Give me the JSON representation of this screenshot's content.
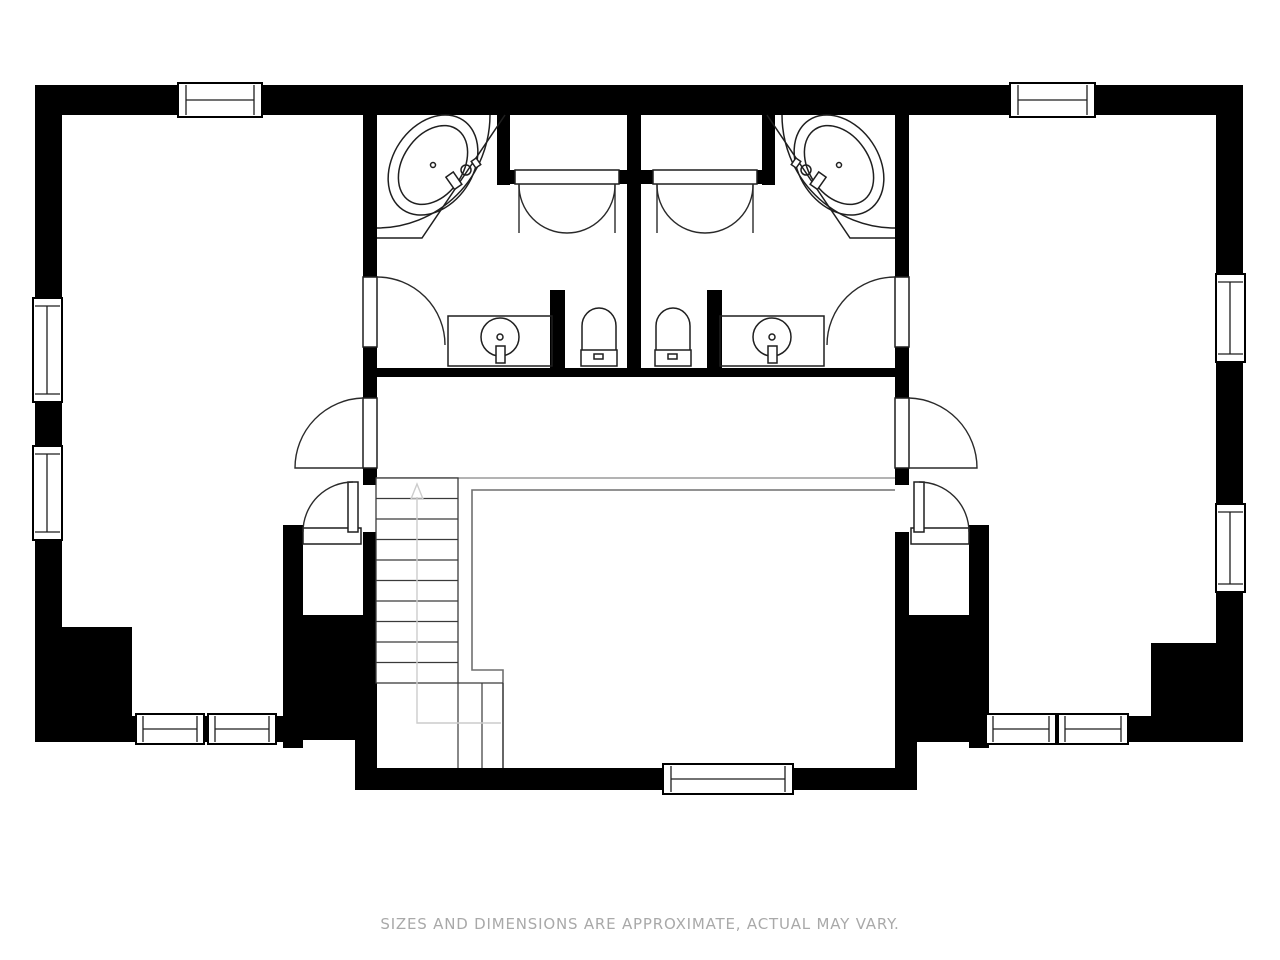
{
  "disclaimer": "SIZES AND DIMENSIONS ARE APPROXIMATE, ACTUAL MAY VARY.",
  "colors": {
    "walls": "#000000",
    "background": "#ffffff",
    "fixture_lines": "#1f1f1f",
    "disclaimer_text": "#a9a9a9",
    "railing": "#6f6f6f",
    "stair_arrow": "#cccccc"
  },
  "fixtures": {
    "tub_left": "corner-bathtub",
    "tub_right": "corner-bathtub",
    "vanity_left": "vanity-with-round-sink",
    "vanity_right": "vanity-with-round-sink",
    "toilet_left": "toilet",
    "toilet_right": "toilet",
    "stairs": "staircase-up",
    "closet_doors": "double-swing-closet-doors"
  }
}
